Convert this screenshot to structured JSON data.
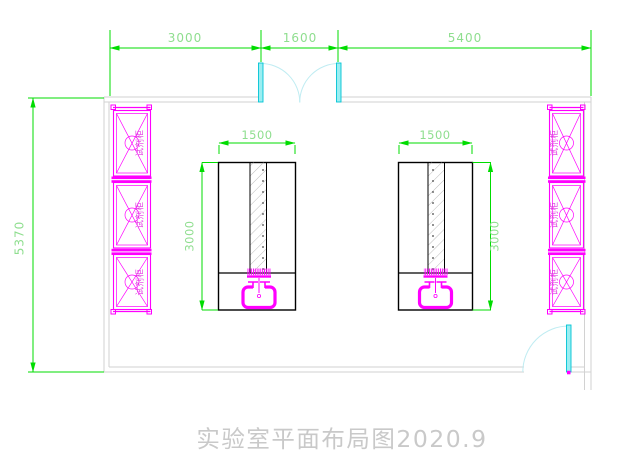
{
  "title": {
    "text": "实验室平面布局图2020.9"
  },
  "dimensions": {
    "top_segments": [
      "3000",
      "1600",
      "5400"
    ],
    "overall_height": "5370",
    "bench_width": "1500",
    "bench_depth": "3000"
  },
  "cabinets": {
    "left": [
      {
        "label": "试剂柜"
      },
      {
        "label": "试剂柜"
      },
      {
        "label": "试剂柜"
      }
    ],
    "right": [
      {
        "label": "试剂柜"
      },
      {
        "label": "试剂柜"
      },
      {
        "label": "试剂柜"
      }
    ]
  },
  "colors": {
    "dimension_line": "#00dc00",
    "dimension_text": "#8fde8f",
    "cabinet": "#ff00ff",
    "door_leaf": "#9beef2",
    "door_arc": "#bfecf2",
    "wall": "#d2d2d2",
    "bench": "#000000",
    "title_text": "#c9c9c9"
  }
}
